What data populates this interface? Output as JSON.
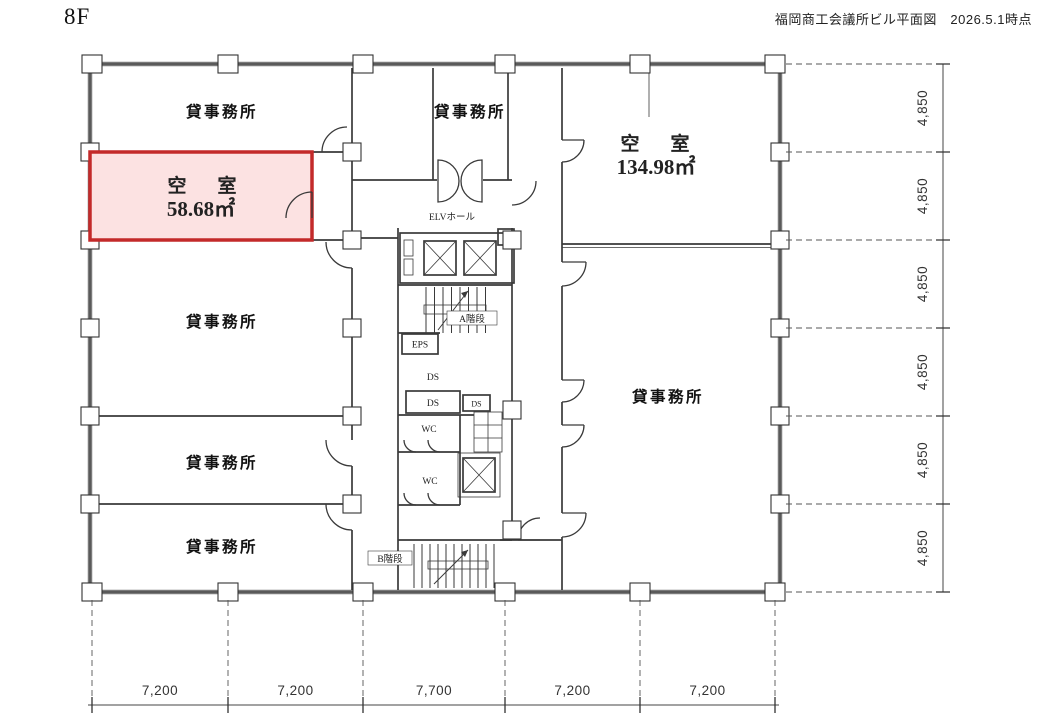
{
  "header": {
    "floor": "8F",
    "title": "福岡商工会議所ビル平面図　2026.5.1時点"
  },
  "rooms": {
    "offices": [
      "貸事務所",
      "貸事務所",
      "貸事務所",
      "貸事務所",
      "貸事務所",
      "貸事務所"
    ],
    "vacant_small": {
      "name": "空　室",
      "area": "58.68㎡"
    },
    "vacant_large": {
      "name": "空　室",
      "area": "134.98㎡"
    }
  },
  "core": {
    "elv_hall": "ELVホール",
    "stair_a": "A階段",
    "stair_b": "B階段",
    "eps": "EPS",
    "ds_1": "DS",
    "ds_2": "DS",
    "ds_3": "DS",
    "wc_1": "WC",
    "wc_2": "WC"
  },
  "dimensions": {
    "bottom": [
      "7,200",
      "7,200",
      "7,700",
      "7,200",
      "7,200"
    ],
    "right": [
      "4,850",
      "4,850",
      "4,850",
      "4,850",
      "4,850",
      "4,850"
    ]
  },
  "colors": {
    "vacant_fill": "#fce2e2",
    "vacant_border": "#c32a2a"
  }
}
